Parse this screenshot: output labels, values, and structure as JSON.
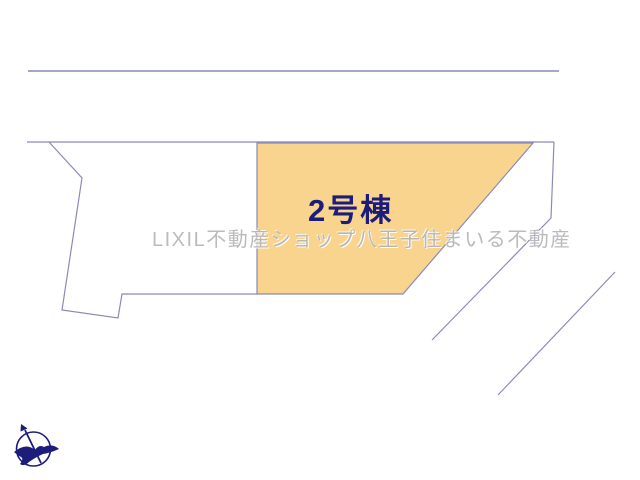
{
  "canvas": {
    "width": 640,
    "height": 480,
    "background": "#ffffff"
  },
  "plot_map": {
    "lot": {
      "label": "2号棟"
    },
    "watermark": {
      "text": "LIXIL不動産ショップ八王子住まいる不動産"
    },
    "compass": {
      "description": "north-arrow compass with bird emblem"
    }
  },
  "colors": {
    "lot_fill": "#f8d48f",
    "boundary_line": "#8a8ab8",
    "road_top_line": "#a6a6c9",
    "lot_label": "#1c1c7a",
    "compass": "#1c1c7a",
    "watermark": "#b4b4b8"
  }
}
